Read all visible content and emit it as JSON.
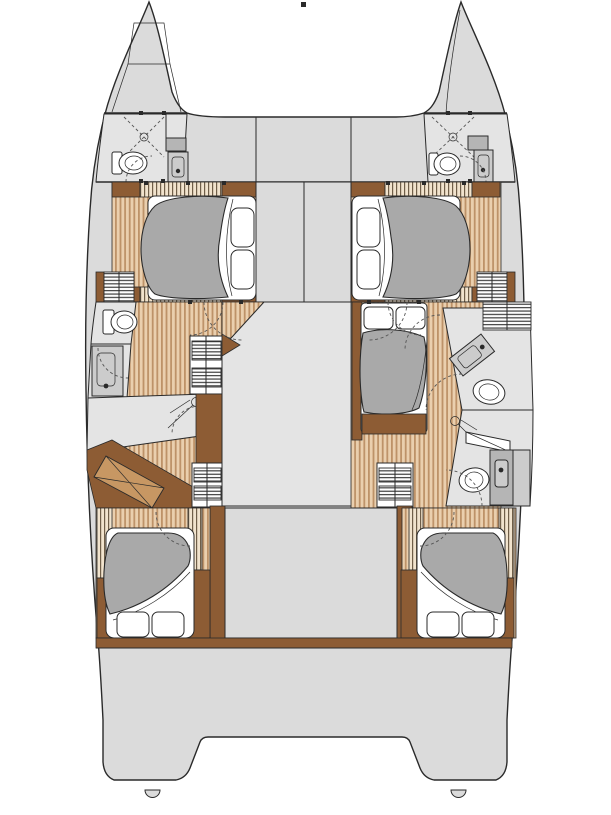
{
  "page": {
    "background": "#ffffff"
  },
  "diagram": {
    "type": "catamaran-interior-deck-plan",
    "orientation": "bow-up",
    "colors": {
      "background": "#ffffff",
      "outline": "#2a2a2a",
      "deck": "#dbdbdb",
      "room": "#e4e4e4",
      "wood_base": "#eacfae",
      "wood_stripe": "#bd9268",
      "slat_base": "#f1e3cd",
      "slat_stripe": "#6f5e48",
      "wood_dark": "#8d5c34",
      "wood_mid": "#c79763",
      "duvet": "#a9a9a9",
      "linen": "#ffffff",
      "fixture": "#cccccc",
      "fixture_dark": "#b5b5b5",
      "louver": "#2e2e2e",
      "dash": "#555555"
    },
    "features": {
      "hulls": [
        "port",
        "starboard"
      ],
      "cabins": [
        {
          "id": "port-forward-cabin",
          "bed": "double"
        },
        {
          "id": "starboard-forward-cabin",
          "bed": "double"
        },
        {
          "id": "starboard-mid-cabin",
          "bed": "double"
        },
        {
          "id": "port-aft-cabin",
          "bed": "double"
        },
        {
          "id": "starboard-aft-cabin",
          "bed": "double"
        }
      ],
      "heads": [
        {
          "id": "port-bow-head",
          "fixtures": [
            "shower",
            "toilet",
            "sink"
          ]
        },
        {
          "id": "starboard-bow-head",
          "fixtures": [
            "shower",
            "toilet",
            "sink"
          ]
        },
        {
          "id": "port-mid-head",
          "fixtures": [
            "toilet",
            "sink",
            "shower"
          ]
        },
        {
          "id": "starboard-forward-head",
          "fixtures": [
            "sink",
            "toilet"
          ]
        },
        {
          "id": "starboard-aft-head",
          "fixtures": [
            "shower",
            "sink",
            "toilet"
          ]
        }
      ]
    }
  }
}
